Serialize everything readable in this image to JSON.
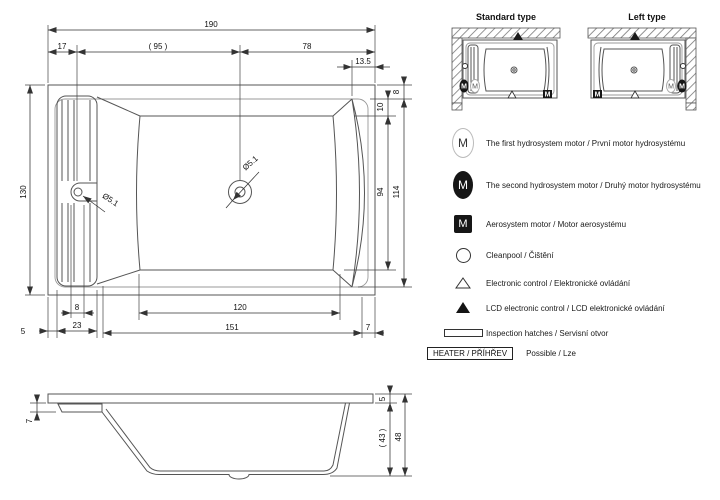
{
  "drawing": {
    "top_view": {
      "dim_total_width": "190",
      "dim_left_offset": "17",
      "dim_mid": "( 95 )",
      "dim_right": "78",
      "dim_13_5": "13.5",
      "dim_height": "130",
      "dim_rim_top": "8",
      "dim_10": "10",
      "dim_inner_height": "94",
      "dim_114": "114",
      "dim_slot": "8",
      "dim_23": "23",
      "dim_5": "5",
      "dim_120": "120",
      "dim_151": "151",
      "dim_7": "7",
      "drain_diameter": "Ø5.1",
      "hole_diameter": "Ø5.1"
    },
    "side_view": {
      "dim_7": "7",
      "dim_5": "5",
      "dim_43": "( 43 )",
      "dim_48": "48"
    }
  },
  "types": {
    "standard": {
      "label": "Standard type"
    },
    "left": {
      "label": "Left type"
    }
  },
  "legend": {
    "motor_letter": "M",
    "items": [
      {
        "symbol": "white-oval-m",
        "label": "The first hydrosystem motor / První motor hydrosystému"
      },
      {
        "symbol": "black-oval-m",
        "label": "The second hydrosystem motor / Druhý motor hydrosystému"
      },
      {
        "symbol": "black-square-m",
        "label": "Aerosystem motor / Motor aerosystému"
      },
      {
        "symbol": "circle",
        "label": "Cleanpool / Čištění"
      },
      {
        "symbol": "triangle-outline",
        "label": "Electronic control / Elektronické ovládání"
      },
      {
        "symbol": "triangle-filled",
        "label": "LCD electronic control / LCD elektronické ovládání"
      },
      {
        "symbol": "inspection-hatch-rect",
        "label": "Inspection hatches / Servisní otvor"
      }
    ],
    "heater": {
      "box_label": "HEATER / PŘÍHŘEV",
      "note": "Possible / Lze"
    }
  },
  "colors": {
    "line": "#555555",
    "dimension": "#333333",
    "text": "#111111",
    "black_symbol": "#161616",
    "background": "#ffffff"
  }
}
